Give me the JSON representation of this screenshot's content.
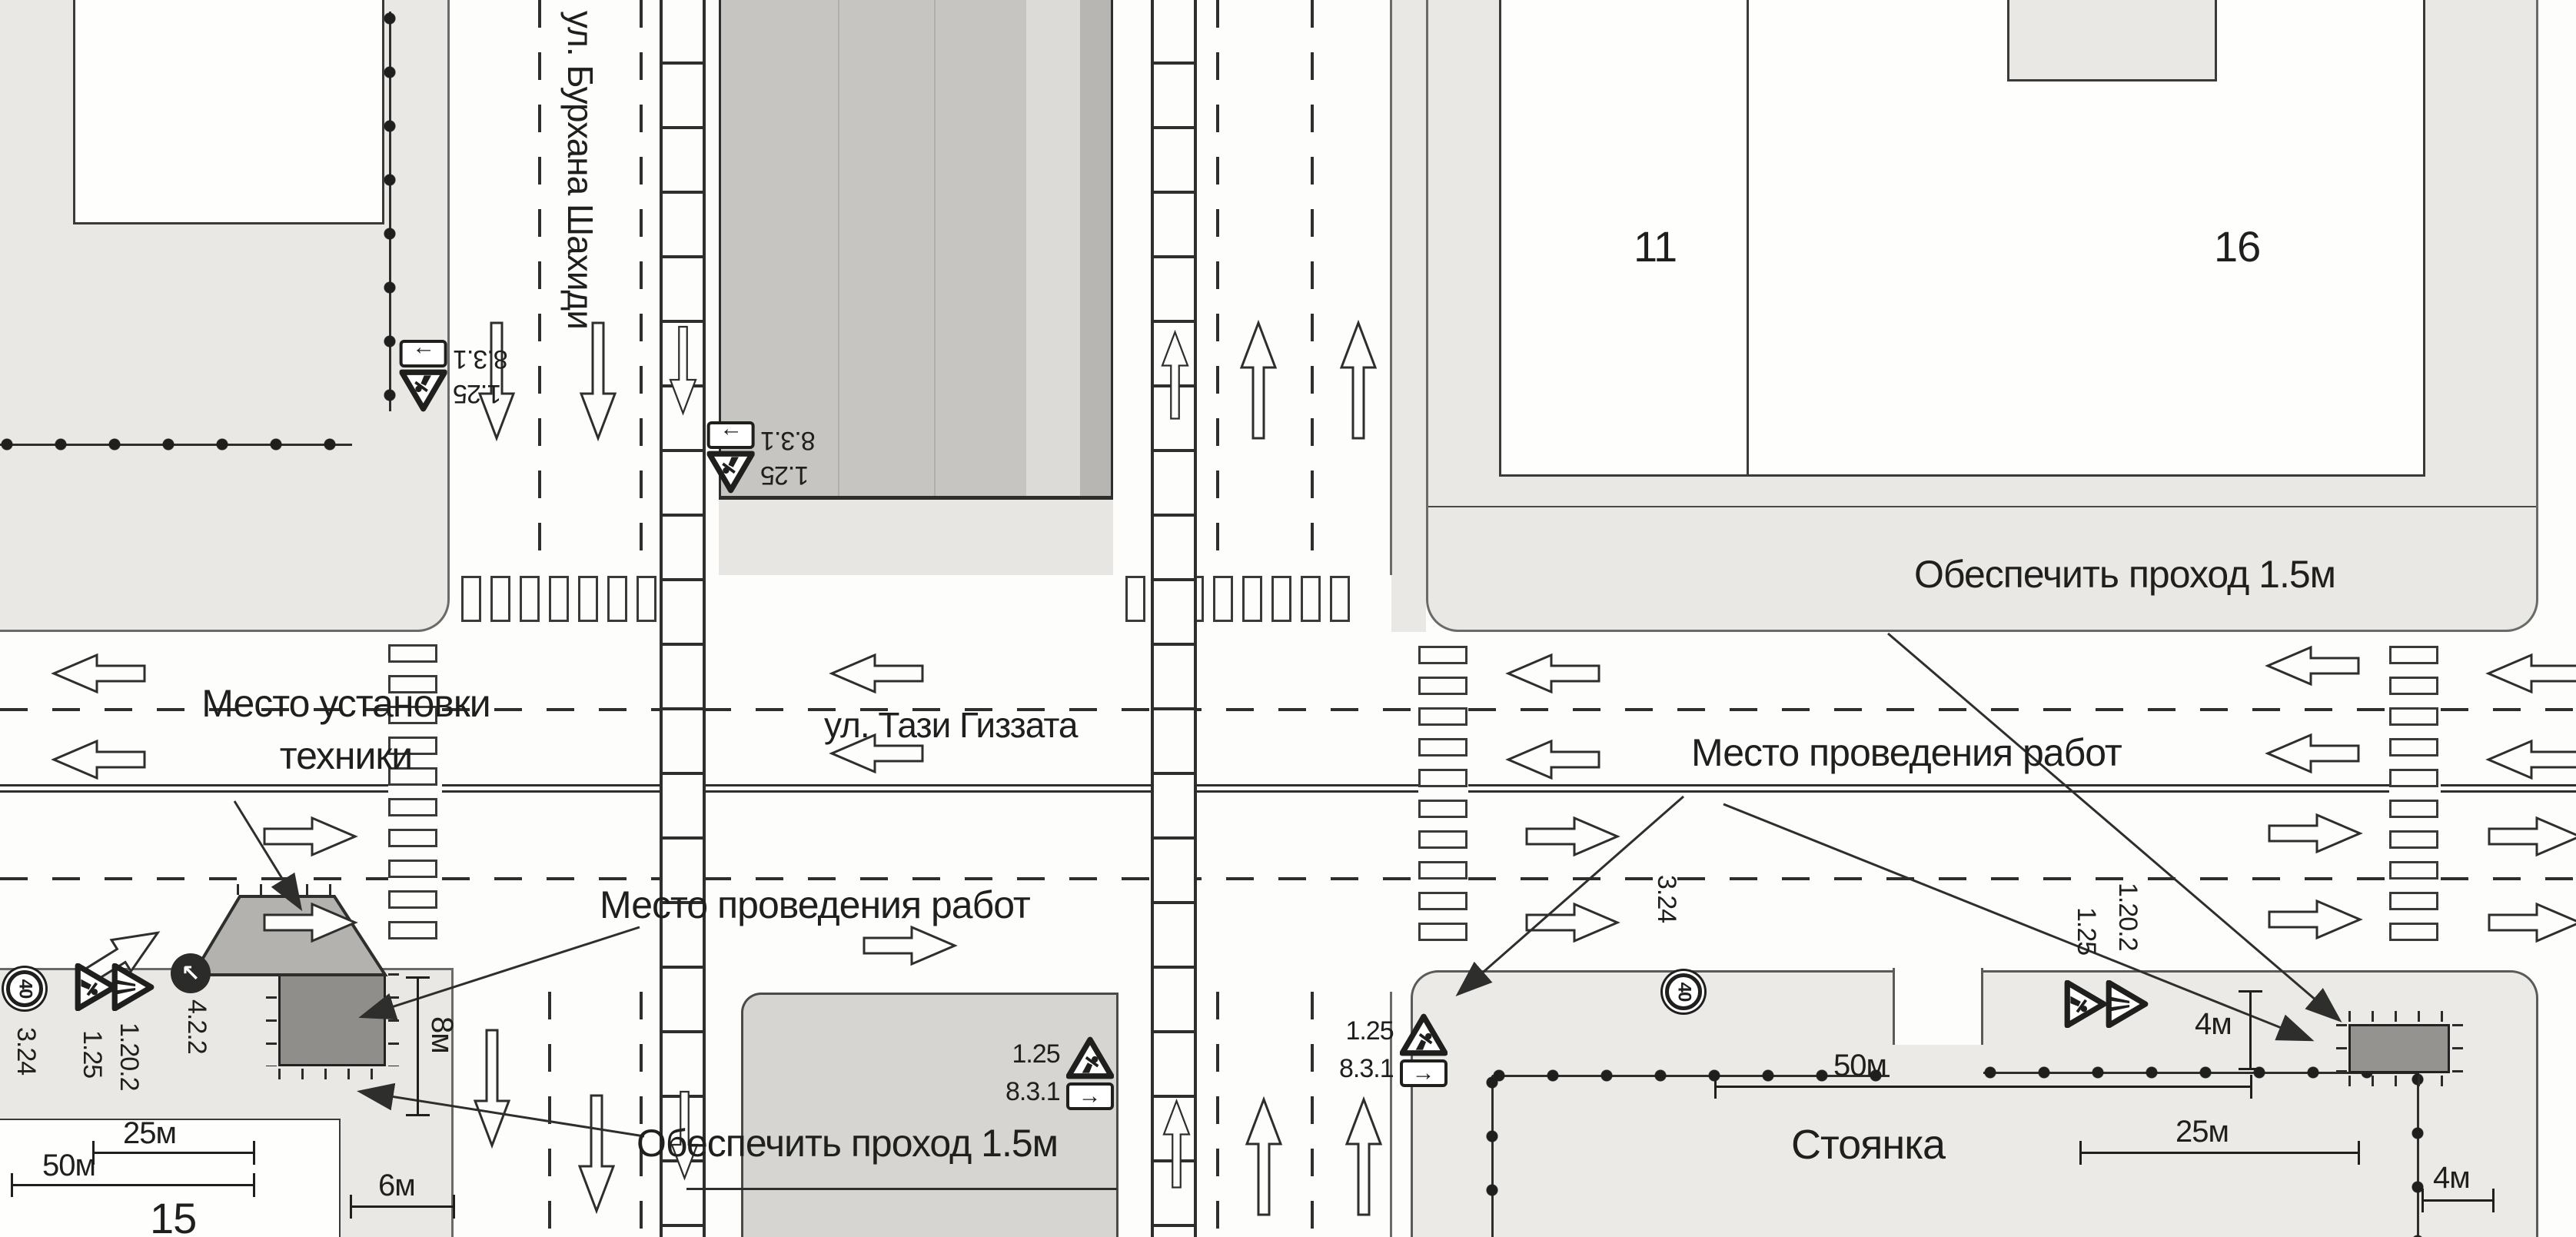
{
  "streets": {
    "vertical": "ул. Бурхана Шахиди",
    "horizontal": "ул. Тази Гиззата"
  },
  "labels": {
    "equipment_area": "Место установки техники",
    "work_area_left": "Место проведения работ",
    "work_area_right": "Место проведения работ",
    "walkway_top": "Обеспечить проход 1.5м",
    "walkway_bottom": "Обеспечить проход 1.5м",
    "parking": "Стоянка"
  },
  "blocks": {
    "b11": "11",
    "b15": "15",
    "b16": "16"
  },
  "dimensions": {
    "left_50": "50м",
    "left_25": "25м",
    "left_6": "6м",
    "left_8": "8м",
    "right_50": "50м",
    "right_25": "25м",
    "right_4_width": "4м",
    "right_4_offset": "4м"
  },
  "signs": {
    "roadworks": "1.25",
    "road_narrows": "1.20.2",
    "direction_plate": "8.3.1",
    "speed_limit": "3.24",
    "speed_value": "40",
    "obstacle_left": "4.2.2"
  },
  "icons": {
    "plate_arrow_right": "→",
    "detour_arrow_nw": "↖"
  }
}
